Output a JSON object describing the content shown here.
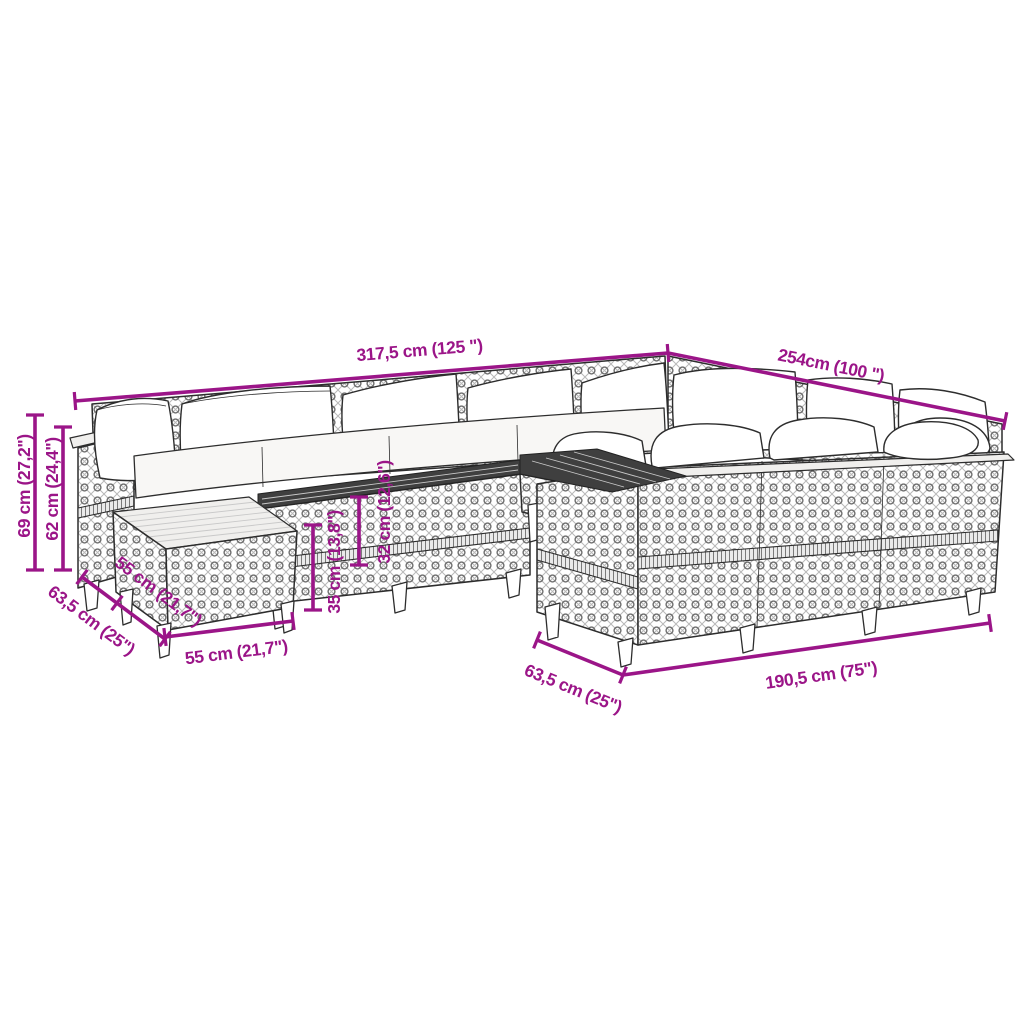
{
  "figure": {
    "title": "Garden sofa set dimension diagram",
    "background_color": "#ffffff",
    "accent_color": "#9B1588",
    "line_art_color": "#2d2d2d"
  },
  "dimensions": {
    "back_total_width": "317,5 cm (125 \")",
    "right_side_length": "254cm (100 \")",
    "total_height": "69 cm (27,2\")",
    "backrest_height": "62 cm (24,4\")",
    "corner_diagonal_depth": "63,5 cm (25\")",
    "ottoman_depth": "55 cm (21,7\")",
    "ottoman_width": "55 cm (21,7\")",
    "seat_height": "35 cm (13,8\")",
    "table_height": "32 cm (12,6\")",
    "front_module_depth": "63,5 cm (25\")",
    "front_row_length": "190,5 cm (75\")"
  }
}
